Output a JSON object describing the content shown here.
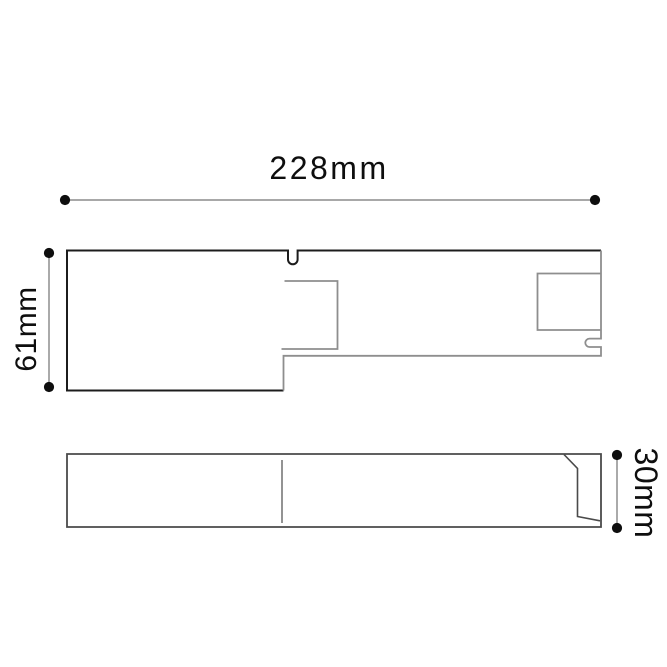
{
  "drawing": {
    "dimension_labels": {
      "width": "228mm",
      "height": "61mm",
      "depth": "30mm"
    },
    "colors": {
      "background": "#ffffff",
      "line_dark": "#1c1c1c",
      "line_gray": "#8e8e8e",
      "side_view_line": "#4a4a4a",
      "side_view_detail": "#787878",
      "dimension_line": "#9b9b9b",
      "dimension_dot": "#0e0e0e",
      "label_text": "#0e0e0e"
    }
  }
}
